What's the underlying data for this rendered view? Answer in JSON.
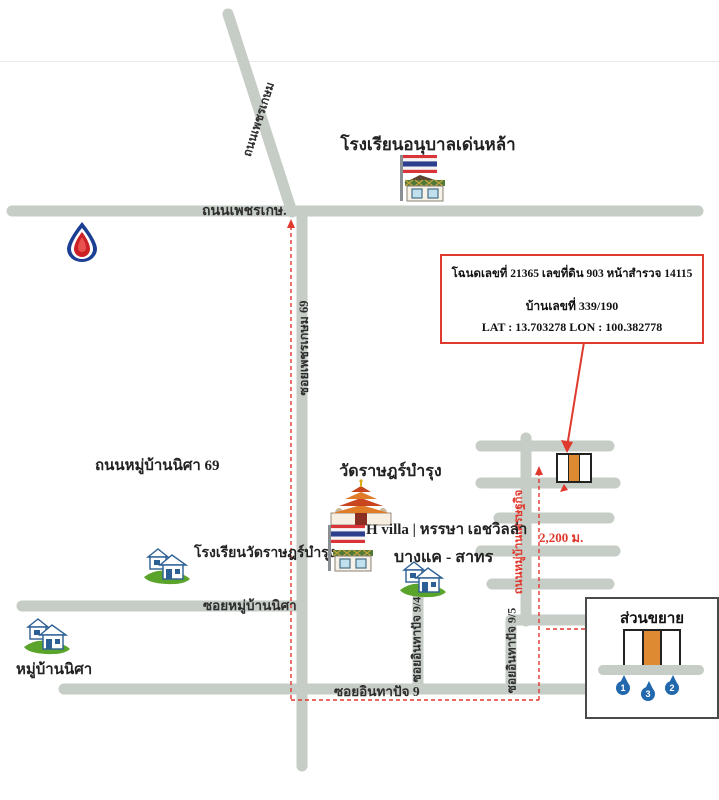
{
  "roads": {
    "phetkasem": "ถนนเพชรเกษ.",
    "diagonal_phetkasem": "ถนนเพชรเกษม",
    "soi_phetkasem_69": "ซอยเพชรเกษม 69",
    "muban_nisa_road_69": "ถนนหมู่บ้านนิศา 69",
    "soi_muban_nisa": "ซอยหมู่บ้านนิศา",
    "soi_inthapat_9": "ซอยอินทาปัจ 9",
    "soi_inthapat_9_4": "ซอยอินทาปัจ 9/4",
    "soi_inthapat_9_5": "ซอยอินทาปัจ 9/5",
    "muban_setthakit_road": "ถนนหมู่บ้านเศรษฐกิจ"
  },
  "places": {
    "kindergarten": "โรงเรียนอนุบาลเด่นหล้า",
    "temple": "วัดราษฎร์บำรุง",
    "h_villa": "H villa | หรรษา เอชวิลล่า",
    "temple_school": "โรงเรียนวัดราษฎร์บำรุง",
    "bangkhae_sathorn": "บางแค - สาทร",
    "muban_nisa_village": "หมู่บ้านนิศา"
  },
  "annotation": {
    "deed_line": "โฉนดเลขที่ 21365 เลขที่ดิน 903 หน้าสำรวจ 14115",
    "house_no_line": "บ้านเลขที่ 339/190",
    "latlon_line": "LAT : 13.703278  LON : 100.382778"
  },
  "distance_label": "2,200 ม.",
  "inset": {
    "title": "ส่วนขยาย",
    "pin1": "1",
    "pin2": "3",
    "pin3": "2"
  },
  "colors": {
    "road_gray": "#c6ccc6",
    "route_red": "#e0392e",
    "plot_orange": "#de8a32",
    "pin_blue": "#2268ad"
  }
}
